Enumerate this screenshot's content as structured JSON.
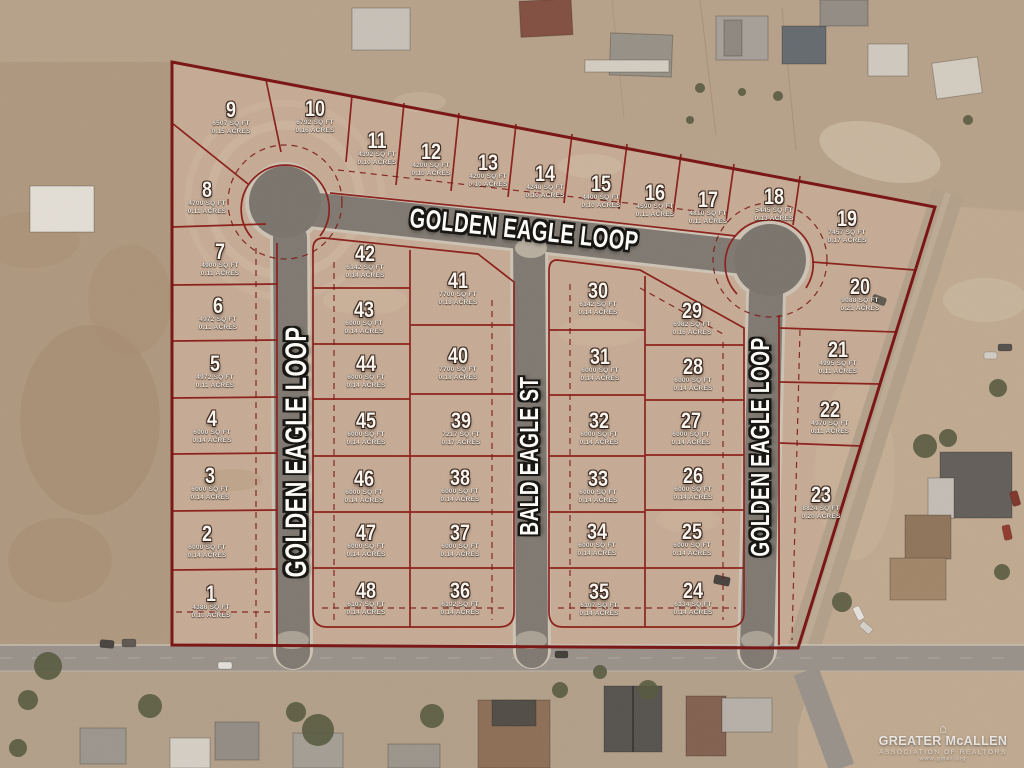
{
  "map": {
    "title": "Golden Eagle Loop subdivision plat over aerial photo",
    "streets": {
      "top": "GOLDEN EAGLE LOOP",
      "left": "GOLDEN EAGLE LOOP",
      "right": "GOLDEN EAGLE LOOP",
      "bald": "BALD EAGLE ST"
    },
    "lots": [
      {
        "number": "1",
        "sqft": "4388 SQ FT",
        "acres": "0.10 ACRES",
        "x": 211,
        "y": 601
      },
      {
        "number": "2",
        "sqft": "6000 SQ FT",
        "acres": "0.14 ACRES",
        "x": 207,
        "y": 541
      },
      {
        "number": "3",
        "sqft": "6000 SQ FT",
        "acres": "0.14 ACRES",
        "x": 210,
        "y": 483
      },
      {
        "number": "4",
        "sqft": "6000 SQ FT",
        "acres": "0.14 ACRES",
        "x": 212,
        "y": 426
      },
      {
        "number": "5",
        "sqft": "4972 SQ FT",
        "acres": "0.11 ACRES",
        "x": 215,
        "y": 371
      },
      {
        "number": "6",
        "sqft": "4972 SQ FT",
        "acres": "0.11 ACRES",
        "x": 218,
        "y": 313
      },
      {
        "number": "7",
        "sqft": "4900 SQ FT",
        "acres": "0.11 ACRES",
        "x": 220,
        "y": 259
      },
      {
        "number": "8",
        "sqft": "4700 SQ FT",
        "acres": "0.11 ACRES",
        "x": 207,
        "y": 197
      },
      {
        "number": "9",
        "sqft": "6507 SQ FT",
        "acres": "0.15 ACRES",
        "x": 231,
        "y": 117
      },
      {
        "number": "10",
        "sqft": "6792 SQ FT",
        "acres": "0.16 ACRES",
        "x": 315,
        "y": 116
      },
      {
        "number": "11",
        "sqft": "4392 SQ FT",
        "acres": "0.10 ACRES",
        "x": 377,
        "y": 148
      },
      {
        "number": "12",
        "sqft": "4200 SQ FT",
        "acres": "0.10 ACRES",
        "x": 431,
        "y": 159
      },
      {
        "number": "13",
        "sqft": "4200 SQ FT",
        "acres": "0.10 ACRES",
        "x": 488,
        "y": 170
      },
      {
        "number": "14",
        "sqft": "4248 SQ FT",
        "acres": "0.10 ACRES",
        "x": 545,
        "y": 181
      },
      {
        "number": "15",
        "sqft": "4400 SQ FT",
        "acres": "0.10 ACRES",
        "x": 601,
        "y": 191
      },
      {
        "number": "16",
        "sqft": "4590 SQ FT",
        "acres": "0.11 ACRES",
        "x": 655,
        "y": 200
      },
      {
        "number": "17",
        "sqft": "4810 SQ FT",
        "acres": "0.11 ACRES",
        "x": 708,
        "y": 207
      },
      {
        "number": "18",
        "sqft": "5445 SQ FT",
        "acres": "0.13 ACRES",
        "x": 774,
        "y": 204
      },
      {
        "number": "19",
        "sqft": "7457 SQ FT",
        "acres": "0.17 ACRES",
        "x": 847,
        "y": 226
      },
      {
        "number": "20",
        "sqft": "9088 SQ FT",
        "acres": "0.21 ACRES",
        "x": 860,
        "y": 294
      },
      {
        "number": "21",
        "sqft": "4995 SQ FT",
        "acres": "0.11 ACRES",
        "x": 838,
        "y": 357
      },
      {
        "number": "22",
        "sqft": "4970 SQ FT",
        "acres": "0.11 ACRES",
        "x": 830,
        "y": 417
      },
      {
        "number": "23",
        "sqft": "8824 SQ FT",
        "acres": "0.20 ACRES",
        "x": 821,
        "y": 502
      },
      {
        "number": "24",
        "sqft": "6134 SQ FT",
        "acres": "0.14 ACRES",
        "x": 693,
        "y": 598
      },
      {
        "number": "25",
        "sqft": "6000 SQ FT",
        "acres": "0.14 ACRES",
        "x": 692,
        "y": 539
      },
      {
        "number": "26",
        "sqft": "6000 SQ FT",
        "acres": "0.14 ACRES",
        "x": 693,
        "y": 483
      },
      {
        "number": "27",
        "sqft": "6000 SQ FT",
        "acres": "0.14 ACRES",
        "x": 691,
        "y": 428
      },
      {
        "number": "28",
        "sqft": "6000 SQ FT",
        "acres": "0.14 ACRES",
        "x": 693,
        "y": 374
      },
      {
        "number": "29",
        "sqft": "6982 SQ FT",
        "acres": "0.16 ACRES",
        "x": 692,
        "y": 318
      },
      {
        "number": "30",
        "sqft": "6142 SQ FT",
        "acres": "0.14 ACRES",
        "x": 598,
        "y": 298
      },
      {
        "number": "31",
        "sqft": "6000 SQ FT",
        "acres": "0.14 ACRES",
        "x": 600,
        "y": 364
      },
      {
        "number": "32",
        "sqft": "6000 SQ FT",
        "acres": "0.14 ACRES",
        "x": 599,
        "y": 428
      },
      {
        "number": "33",
        "sqft": "6000 SQ FT",
        "acres": "0.14 ACRES",
        "x": 598,
        "y": 486
      },
      {
        "number": "34",
        "sqft": "6000 SQ FT",
        "acres": "0.14 ACRES",
        "x": 597,
        "y": 539
      },
      {
        "number": "35",
        "sqft": "6107 SQ FT",
        "acres": "0.14 ACRES",
        "x": 599,
        "y": 599
      },
      {
        "number": "36",
        "sqft": "6102 SQ FT",
        "acres": "0.14 ACRES",
        "x": 460,
        "y": 598
      },
      {
        "number": "37",
        "sqft": "6000 SQ FT",
        "acres": "0.14 ACRES",
        "x": 460,
        "y": 540
      },
      {
        "number": "38",
        "sqft": "6000 SQ FT",
        "acres": "0.14 ACRES",
        "x": 460,
        "y": 485
      },
      {
        "number": "39",
        "sqft": "7217 SQ FT",
        "acres": "0.17 ACRES",
        "x": 461,
        "y": 428
      },
      {
        "number": "40",
        "sqft": "7700 SQ FT",
        "acres": "0.18 ACRES",
        "x": 458,
        "y": 363
      },
      {
        "number": "41",
        "sqft": "7700 SQ FT",
        "acres": "0.18 ACRES",
        "x": 458,
        "y": 288
      },
      {
        "number": "42",
        "sqft": "6142 SQ FT",
        "acres": "0.14 ACRES",
        "x": 365,
        "y": 261
      },
      {
        "number": "43",
        "sqft": "6000 SQ FT",
        "acres": "0.14 ACRES",
        "x": 364,
        "y": 317
      },
      {
        "number": "44",
        "sqft": "6000 SQ FT",
        "acres": "0.14 ACRES",
        "x": 366,
        "y": 371
      },
      {
        "number": "45",
        "sqft": "6000 SQ FT",
        "acres": "0.14 ACRES",
        "x": 366,
        "y": 428
      },
      {
        "number": "46",
        "sqft": "6000 SQ FT",
        "acres": "0.14 ACRES",
        "x": 364,
        "y": 486
      },
      {
        "number": "47",
        "sqft": "6000 SQ FT",
        "acres": "0.14 ACRES",
        "x": 366,
        "y": 540
      },
      {
        "number": "48",
        "sqft": "6107 SQ FT",
        "acres": "0.14 ACRES",
        "x": 366,
        "y": 598
      }
    ],
    "watermark": {
      "icon": "house-icon",
      "line1": "GREATER McALLEN",
      "line2": "ASSOCIATION OF REALTORS",
      "line3": "www.gmar.org"
    },
    "colors": {
      "plat_line": "#7e1b18",
      "terrain": "#c9ad97",
      "road": "#7b756f",
      "label_text": "#f7f4ee"
    }
  }
}
